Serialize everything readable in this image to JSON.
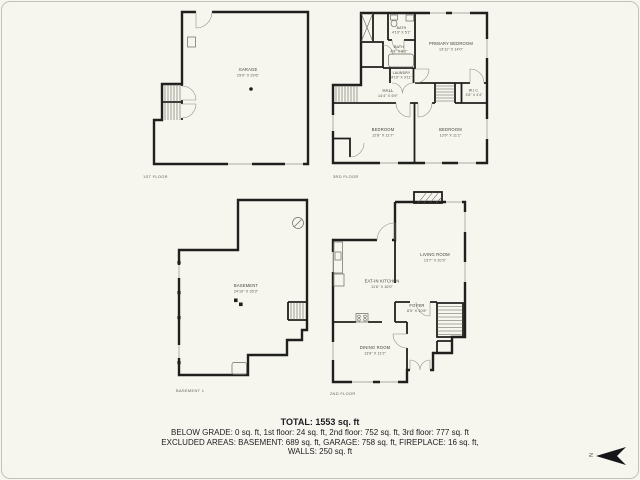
{
  "plans": {
    "first_floor": {
      "floor_label": "1ST FLOOR",
      "rooms": {
        "garage": {
          "name": "GARAGE",
          "dims": "29'9\" X 29'6\""
        }
      }
    },
    "third_floor": {
      "floor_label": "3RD FLOOR",
      "rooms": {
        "bath_top": {
          "name": "BATH",
          "dims": "4'10\" X 5'1\""
        },
        "bath_mid": {
          "name": "BATH",
          "dims": "4'8\" X 5'2\""
        },
        "laundry": {
          "name": "LAUNDRY",
          "dims": "4'10\" X 3'11\""
        },
        "hall": {
          "name": "HALL",
          "dims": "14'4\" X 6'9\""
        },
        "primary_bedroom": {
          "name": "PRIMARY BEDROOM",
          "dims": "13'11\" X 14'0\""
        },
        "wic": {
          "name": "W.I.C.",
          "dims": "3'8\" X 4'4\""
        },
        "bedroom_left": {
          "name": "BEDROOM",
          "dims": "12'8\" X 11'7\""
        },
        "bedroom_right": {
          "name": "BEDROOM",
          "dims": "13'9\" X 11'1\""
        }
      }
    },
    "basement": {
      "floor_label": "BASEMENT 1",
      "rooms": {
        "basement": {
          "name": "BASEMENT",
          "dims": "24'10\" X 35'3\""
        }
      }
    },
    "second_floor": {
      "floor_label": "2ND FLOOR",
      "rooms": {
        "living_room": {
          "name": "LIVING ROOM",
          "dims": "13'7\" X 20'3\""
        },
        "eat_in_kitchen": {
          "name": "EAT-IN KITCHEN",
          "dims": "11'6\" X 16'0\""
        },
        "foyer": {
          "name": "FOYER",
          "dims": "8'5\" X 10'8\""
        },
        "dining_room": {
          "name": "DINING ROOM",
          "dims": "13'9\" X 11'2\""
        }
      }
    }
  },
  "summary": {
    "total": "TOTAL: 1553 sq. ft",
    "below_grade": "BELOW GRADE: 0 sq. ft, 1st floor: 24 sq. ft, 2nd floor: 752 sq. ft, 3rd floor: 777 sq. ft",
    "excluded": "EXCLUDED AREAS: BASEMENT: 689 sq. ft, GARAGE: 758 sq. ft, FIREPLACE: 16 sq. ft,",
    "walls": "WALLS: 250 sq. ft"
  },
  "compass": {
    "letter": "N"
  },
  "colors": {
    "background": "#f7f6ee",
    "wall": "#1f1f1d",
    "text": "#43433c"
  }
}
